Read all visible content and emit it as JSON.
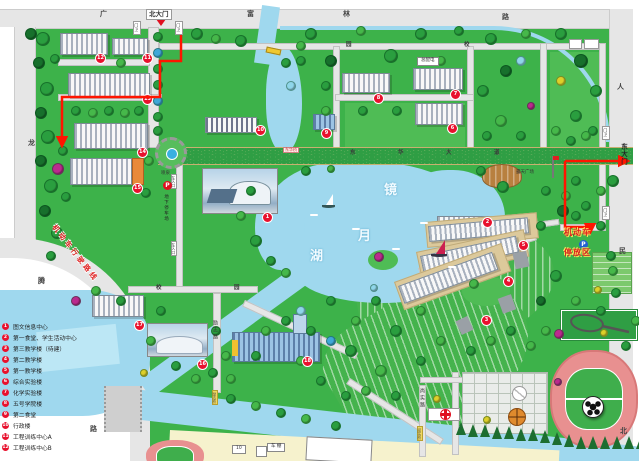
{
  "colors": {
    "grass": "#3db24a",
    "water": "#9fd8ee",
    "avenue_tan": "#ead9a0",
    "marker_red": "#e8112d",
    "route_red": "#ff1500",
    "legend_red": "#e8112d"
  },
  "legend": {
    "items": [
      {
        "num": "1",
        "label": "图文信息中心"
      },
      {
        "num": "2",
        "label": "第一食堂、学生活动中心"
      },
      {
        "num": "3",
        "label": "第三教学楼（待建）"
      },
      {
        "num": "4",
        "label": "第二教学楼"
      },
      {
        "num": "5",
        "label": "第一教学楼"
      },
      {
        "num": "6",
        "label": "综合实验楼"
      },
      {
        "num": "7",
        "label": "化学实验楼"
      },
      {
        "num": "8",
        "label": "五号学院楼"
      },
      {
        "num": "9",
        "label": "第二食堂"
      },
      {
        "num": "10",
        "label": "行政楼"
      },
      {
        "num": "11",
        "label": "工程训练中心A"
      },
      {
        "num": "12",
        "label": "工程训练中心B"
      }
    ]
  },
  "markers": [
    {
      "n": "1",
      "x": 262,
      "y": 212
    },
    {
      "n": "2",
      "x": 482,
      "y": 217
    },
    {
      "n": "3",
      "x": 481,
      "y": 315
    },
    {
      "n": "4",
      "x": 503,
      "y": 276
    },
    {
      "n": "5",
      "x": 518,
      "y": 240
    },
    {
      "n": "6",
      "x": 447,
      "y": 123
    },
    {
      "n": "7",
      "x": 450,
      "y": 89
    },
    {
      "n": "8",
      "x": 373,
      "y": 93
    },
    {
      "n": "9",
      "x": 321,
      "y": 128
    },
    {
      "n": "10",
      "x": 255,
      "y": 125
    },
    {
      "n": "11",
      "x": 142,
      "y": 53
    },
    {
      "n": "12",
      "x": 95,
      "y": 53
    },
    {
      "n": "13",
      "x": 142,
      "y": 94
    },
    {
      "n": "14",
      "x": 137,
      "y": 147
    },
    {
      "n": "15",
      "x": 132,
      "y": 183
    },
    {
      "n": "16",
      "x": 197,
      "y": 359
    },
    {
      "n": "17",
      "x": 134,
      "y": 320
    },
    {
      "n": "18",
      "x": 302,
      "y": 356
    }
  ],
  "labels": [
    {
      "t": "广",
      "x": 100,
      "y": 11,
      "cls": "roadchar",
      "name": "road-label-guang"
    },
    {
      "t": "富",
      "x": 247,
      "y": 11,
      "cls": "roadchar",
      "name": "road-label-fu"
    },
    {
      "t": "林",
      "x": 343,
      "y": 11,
      "cls": "roadchar",
      "name": "road-label-lin"
    },
    {
      "t": "路",
      "x": 502,
      "y": 14,
      "cls": "roadchar",
      "name": "road-label-lu"
    },
    {
      "t": "人",
      "x": 617,
      "y": 84,
      "cls": "roadchar",
      "name": "road-label-ren"
    },
    {
      "t": "民",
      "x": 619,
      "y": 248,
      "cls": "roadchar",
      "name": "road-label-min"
    },
    {
      "t": "北",
      "x": 620,
      "y": 428,
      "cls": "roadchar",
      "name": "road-label-bei"
    },
    {
      "t": "龙",
      "x": 28,
      "y": 140,
      "cls": "roadchar",
      "name": "road-label-long"
    },
    {
      "t": "腾",
      "x": 38,
      "y": 278,
      "cls": "roadchar",
      "name": "road-label-teng"
    },
    {
      "t": "路",
      "x": 90,
      "y": 426,
      "cls": "roadchar",
      "name": "road-label-lu-west"
    },
    {
      "t": "园",
      "x": 346,
      "y": 43,
      "cls": "roadchar-s",
      "name": "campus-road-label"
    },
    {
      "t": "校",
      "x": 464,
      "y": 43,
      "cls": "roadchar-s",
      "name": "campus-road-label"
    },
    {
      "t": "校",
      "x": 156,
      "y": 286,
      "cls": "roadchar-s",
      "name": "campus-road-label"
    },
    {
      "t": "园",
      "x": 234,
      "y": 286,
      "cls": "roadchar-s",
      "name": "campus-road-label"
    },
    {
      "t": "东",
      "x": 350,
      "y": 151,
      "cls": "roadchar-s",
      "name": "avenue-label-dong"
    },
    {
      "t": "华",
      "x": 398,
      "y": 151,
      "cls": "roadchar-s",
      "name": "avenue-label-hua"
    },
    {
      "t": "大",
      "x": 446,
      "y": 151,
      "cls": "roadchar-s",
      "name": "avenue-label-da"
    },
    {
      "t": "道",
      "x": 494,
      "y": 151,
      "cls": "roadchar-s",
      "name": "avenue-label-dao"
    },
    {
      "t": "励志路",
      "x": 212,
      "y": 320,
      "cls": "vroad",
      "name": "lizhi-road-label"
    },
    {
      "t": "尚实路",
      "x": 419,
      "y": 388,
      "cls": "vroad",
      "name": "shangshi-road-label"
    },
    {
      "t": "北大门",
      "x": 146,
      "y": 9,
      "cls": "gate-sign",
      "name": "north-gate-sign"
    },
    {
      "t": "东大门",
      "x": 620,
      "y": 143,
      "cls": "gate-sign-v",
      "name": "east-gate-sign"
    },
    {
      "t": "门卫",
      "x": 133,
      "y": 21,
      "cls": "guard",
      "name": "guard-box"
    },
    {
      "t": "门卫",
      "x": 175,
      "y": 21,
      "cls": "guard",
      "name": "guard-box"
    },
    {
      "t": "门卫",
      "x": 602,
      "y": 126,
      "cls": "guard",
      "name": "guard-box"
    },
    {
      "t": "门卫",
      "x": 602,
      "y": 206,
      "cls": "guard",
      "name": "guard-box"
    },
    {
      "t": "镜",
      "x": 384,
      "y": 184,
      "cls": "lake-char",
      "name": "lake-name-jing"
    },
    {
      "t": "月",
      "x": 358,
      "y": 230,
      "cls": "lake-char",
      "name": "lake-name-yue"
    },
    {
      "t": "湖",
      "x": 310,
      "y": 250,
      "cls": "lake-char",
      "name": "lake-name-hu"
    },
    {
      "t": "东华桥",
      "x": 283,
      "y": 147,
      "cls": "bridge-red",
      "name": "donghua-bridge-sign"
    },
    {
      "t": "励志桥",
      "x": 212,
      "y": 390,
      "cls": "bridge-y",
      "name": "lizhi-bridge-sign"
    },
    {
      "t": "尚实桥",
      "x": 417,
      "y": 426,
      "cls": "bridge-y",
      "name": "shangshi-bridge-sign"
    },
    {
      "t": "喷泉",
      "x": 161,
      "y": 172,
      "cls": "tiny",
      "name": "fountain-label"
    },
    {
      "t": "露天广场",
      "x": 516,
      "y": 171,
      "cls": "tiny",
      "name": "open-plaza-label"
    },
    {
      "t": "总配电",
      "x": 417,
      "y": 57,
      "cls": "sign-box",
      "name": "power-station-sign"
    },
    {
      "t": "地下停车场",
      "x": 163,
      "y": 194,
      "cls": "vpark",
      "name": "underground-parking-label"
    },
    {
      "t": "车入口",
      "x": 171,
      "y": 174,
      "cls": "ventry",
      "name": "car-entrance-sign"
    },
    {
      "t": "车入口",
      "x": 171,
      "y": 241,
      "cls": "ventry",
      "name": "car-entrance-sign"
    },
    {
      "t": "P",
      "x": 163,
      "y": 181,
      "cls": "p-red",
      "name": "parking-icon"
    },
    {
      "t": "P",
      "x": 579,
      "y": 240,
      "cls": "p-blue",
      "name": "parking-icon"
    },
    {
      "t": "机动车",
      "x": 564,
      "y": 229,
      "cls": "pk-red",
      "name": "motor-parking-label-1"
    },
    {
      "t": "停放区",
      "x": 564,
      "y": 249,
      "cls": "pk-red",
      "name": "motor-parking-label-2"
    },
    {
      "t": "机动车行驶路线",
      "x": 56,
      "y": 224,
      "cls": "route-label",
      "name": "vehicle-route-label"
    },
    {
      "t": "10",
      "x": 232,
      "y": 445,
      "cls": "sign-box",
      "name": "building-10-sign"
    },
    {
      "t": "车 棚",
      "x": 267,
      "y": 443,
      "cls": "sign-box",
      "name": "bike-shed-sign"
    }
  ],
  "trees": [
    [
      42,
      38,
      6,
      1
    ],
    [
      30,
      33,
      5,
      0
    ],
    [
      38,
      62,
      5,
      0
    ],
    [
      46,
      88,
      6,
      1
    ],
    [
      40,
      112,
      5,
      0
    ],
    [
      47,
      136,
      6,
      1
    ],
    [
      40,
      160,
      5,
      0
    ],
    [
      50,
      185,
      6,
      1
    ],
    [
      44,
      210,
      5,
      0
    ],
    [
      57,
      168,
      5,
      6
    ],
    [
      56,
      232,
      5,
      1
    ],
    [
      50,
      255,
      4,
      1
    ],
    [
      157,
      36,
      4,
      1
    ],
    [
      157,
      52,
      4,
      4
    ],
    [
      157,
      68,
      4,
      1
    ],
    [
      157,
      84,
      4,
      1
    ],
    [
      157,
      100,
      4,
      4
    ],
    [
      157,
      116,
      4,
      1
    ],
    [
      157,
      130,
      4,
      1
    ],
    [
      54,
      58,
      4,
      1
    ],
    [
      120,
      62,
      4,
      2
    ],
    [
      75,
      110,
      4,
      1
    ],
    [
      92,
      112,
      4,
      2
    ],
    [
      108,
      110,
      4,
      1
    ],
    [
      124,
      112,
      4,
      2
    ],
    [
      138,
      110,
      4,
      1
    ],
    [
      62,
      150,
      4,
      1
    ],
    [
      148,
      160,
      4,
      2
    ],
    [
      65,
      196,
      4,
      1
    ],
    [
      145,
      192,
      4,
      1
    ],
    [
      196,
      33,
      5,
      1
    ],
    [
      215,
      38,
      4,
      2
    ],
    [
      240,
      40,
      5,
      1
    ],
    [
      310,
      33,
      5,
      1
    ],
    [
      330,
      60,
      5,
      0
    ],
    [
      360,
      30,
      4,
      2
    ],
    [
      390,
      55,
      6,
      1
    ],
    [
      420,
      33,
      5,
      1
    ],
    [
      440,
      60,
      4,
      2
    ],
    [
      458,
      30,
      4,
      1
    ],
    [
      490,
      38,
      5,
      1
    ],
    [
      505,
      70,
      5,
      0
    ],
    [
      525,
      33,
      4,
      2
    ],
    [
      560,
      33,
      5,
      1
    ],
    [
      580,
      60,
      6,
      0
    ],
    [
      595,
      90,
      5,
      1
    ],
    [
      560,
      80,
      4,
      7
    ],
    [
      520,
      60,
      4,
      5
    ],
    [
      575,
      115,
      5,
      1
    ],
    [
      555,
      130,
      4,
      2
    ],
    [
      592,
      130,
      4,
      1
    ],
    [
      482,
      90,
      5,
      1
    ],
    [
      500,
      120,
      5,
      2
    ],
    [
      486,
      135,
      4,
      1
    ],
    [
      520,
      135,
      4,
      1
    ],
    [
      325,
      85,
      4,
      1
    ],
    [
      325,
      110,
      4,
      2
    ],
    [
      362,
      110,
      4,
      1
    ],
    [
      396,
      110,
      4,
      1
    ],
    [
      300,
      60,
      4,
      1
    ],
    [
      290,
      85,
      4,
      5
    ],
    [
      530,
      105,
      3,
      6
    ],
    [
      305,
      170,
      4,
      1
    ],
    [
      330,
      168,
      3,
      2
    ],
    [
      480,
      170,
      4,
      1
    ],
    [
      502,
      186,
      5,
      1
    ],
    [
      545,
      190,
      4,
      1
    ],
    [
      562,
      210,
      5,
      0
    ],
    [
      585,
      205,
      4,
      1
    ],
    [
      600,
      190,
      4,
      2
    ],
    [
      540,
      225,
      4,
      1
    ],
    [
      572,
      230,
      4,
      2
    ],
    [
      555,
      275,
      5,
      1
    ],
    [
      575,
      300,
      4,
      2
    ],
    [
      600,
      310,
      4,
      1
    ],
    [
      540,
      300,
      4,
      0
    ],
    [
      597,
      289,
      3,
      7
    ],
    [
      558,
      333,
      4,
      6
    ],
    [
      603,
      332,
      3,
      7
    ],
    [
      250,
      190,
      4,
      1
    ],
    [
      240,
      215,
      4,
      2
    ],
    [
      255,
      240,
      5,
      1
    ],
    [
      270,
      260,
      4,
      1
    ],
    [
      285,
      272,
      4,
      2
    ],
    [
      330,
      300,
      4,
      1
    ],
    [
      355,
      320,
      4,
      2
    ],
    [
      375,
      300,
      4,
      1
    ],
    [
      395,
      330,
      5,
      1
    ],
    [
      420,
      310,
      4,
      2
    ],
    [
      350,
      350,
      5,
      1
    ],
    [
      380,
      370,
      5,
      2
    ],
    [
      330,
      340,
      4,
      4
    ],
    [
      310,
      330,
      4,
      1
    ],
    [
      300,
      360,
      4,
      2
    ],
    [
      320,
      380,
      4,
      1
    ],
    [
      345,
      395,
      4,
      1
    ],
    [
      365,
      390,
      4,
      2
    ],
    [
      395,
      395,
      4,
      1
    ],
    [
      420,
      360,
      4,
      1
    ],
    [
      440,
      340,
      4,
      2
    ],
    [
      436,
      398,
      3,
      7
    ],
    [
      300,
      310,
      4,
      5
    ],
    [
      285,
      320,
      4,
      1
    ],
    [
      265,
      330,
      4,
      2
    ],
    [
      255,
      355,
      4,
      1
    ],
    [
      160,
      310,
      4,
      1
    ],
    [
      150,
      340,
      4,
      2
    ],
    [
      175,
      365,
      4,
      1
    ],
    [
      195,
      378,
      4,
      2
    ],
    [
      230,
      398,
      4,
      1
    ],
    [
      255,
      405,
      4,
      2
    ],
    [
      280,
      412,
      4,
      1
    ],
    [
      305,
      418,
      4,
      2
    ],
    [
      335,
      425,
      4,
      1
    ],
    [
      143,
      372,
      3,
      7
    ],
    [
      120,
      300,
      4,
      1
    ],
    [
      95,
      290,
      4,
      2
    ],
    [
      75,
      300,
      4,
      6
    ],
    [
      215,
      330,
      4,
      1
    ],
    [
      225,
      355,
      4,
      2
    ],
    [
      212,
      372,
      4,
      1
    ],
    [
      230,
      378,
      4,
      2
    ],
    [
      470,
      350,
      4,
      1
    ],
    [
      490,
      340,
      4,
      2
    ],
    [
      510,
      330,
      4,
      1
    ],
    [
      530,
      345,
      4,
      2
    ],
    [
      486,
      419,
      3,
      7
    ],
    [
      545,
      330,
      4,
      2
    ],
    [
      625,
      345,
      4,
      1
    ],
    [
      635,
      320,
      4,
      2
    ],
    [
      615,
      292,
      4,
      1
    ],
    [
      557,
      381,
      3,
      6
    ],
    [
      570,
      140,
      4,
      1
    ],
    [
      585,
      135,
      4,
      2
    ],
    [
      612,
      180,
      5,
      1
    ],
    [
      575,
      180,
      4,
      1
    ],
    [
      565,
      195,
      4,
      2
    ],
    [
      610,
      255,
      4,
      1
    ],
    [
      612,
      270,
      4,
      2
    ],
    [
      600,
      225,
      4,
      1
    ],
    [
      575,
      215,
      4,
      1
    ],
    [
      378,
      256,
      4,
      6
    ],
    [
      473,
      283,
      4,
      2
    ],
    [
      373,
      287,
      3,
      5
    ],
    [
      300,
      45,
      4,
      2
    ],
    [
      285,
      62,
      4,
      1
    ],
    [
      552,
      432,
      0,
      8
    ],
    [
      564,
      434,
      0,
      8
    ],
    [
      576,
      436,
      0,
      8
    ],
    [
      588,
      436,
      0,
      8
    ],
    [
      600,
      436,
      0,
      8
    ],
    [
      612,
      436,
      0,
      8
    ],
    [
      624,
      436,
      0,
      8
    ],
    [
      636,
      436,
      0,
      8
    ],
    [
      540,
      430,
      0,
      8
    ],
    [
      528,
      428,
      0,
      8
    ],
    [
      516,
      428,
      0,
      8
    ],
    [
      504,
      426,
      0,
      8
    ],
    [
      492,
      426,
      0,
      8
    ],
    [
      480,
      424,
      0,
      8
    ],
    [
      468,
      424,
      0,
      8
    ],
    [
      456,
      422,
      0,
      8
    ]
  ],
  "tree_palette": [
    "#17702c",
    "#2a9e3f",
    "#46b84a",
    "#7ccf6a",
    "#3fa8d8",
    "#8fd6ea",
    "#bb2a8e",
    "#ddd02a",
    "#1d6e30"
  ]
}
